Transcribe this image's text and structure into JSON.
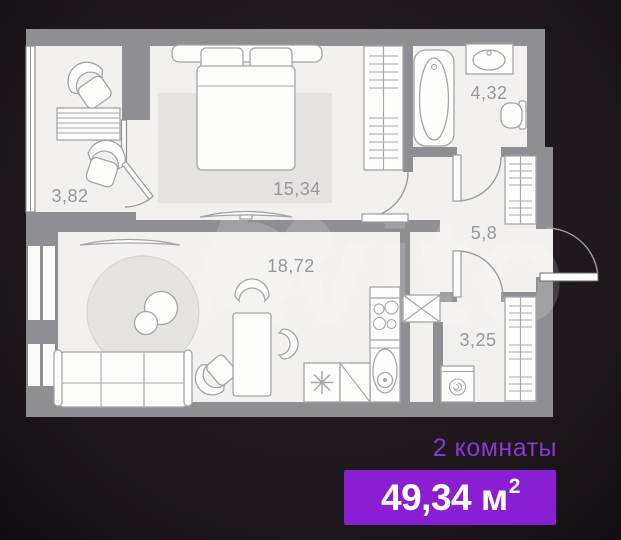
{
  "watermark": "Avito",
  "rooms": {
    "balcony": "3,82",
    "bedroom": "15,34",
    "bathroom": "4,32",
    "hallway": "5,8",
    "living_kitchen": "18,72",
    "utility": "3,25"
  },
  "footer": {
    "rooms_label": "2 комнаты",
    "area_value": "49,34 м",
    "area_superscript": "2"
  },
  "colors": {
    "accent_purple": "#8a1ed2",
    "rooms_label_purple": "#8d36d8",
    "wall_gray": "#8f8e92",
    "floor_light": "#f2f1ef",
    "background_dark": "#1d171b",
    "area_label_gray": "#97969d"
  }
}
